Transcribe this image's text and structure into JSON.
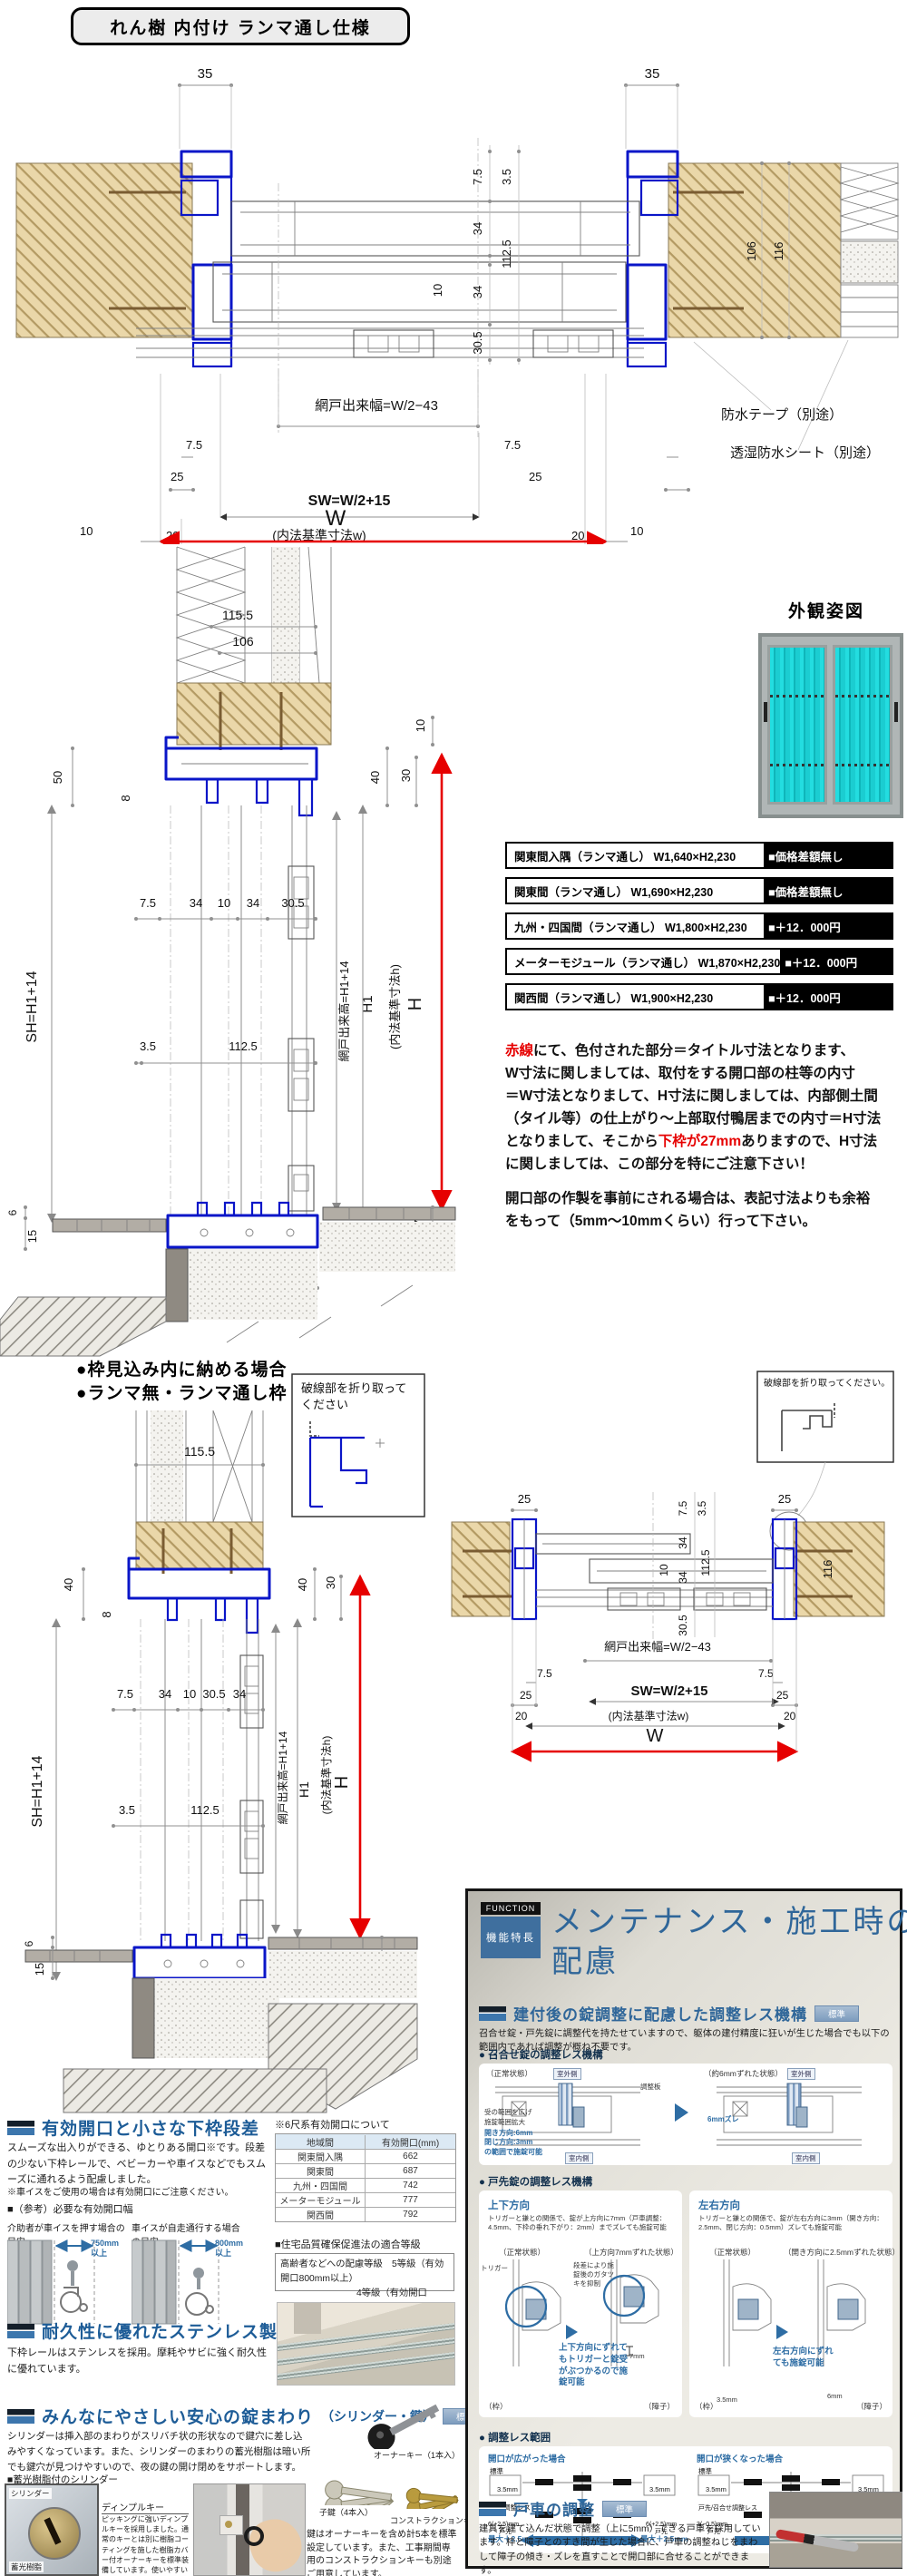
{
  "title": "れん樹 内付け ランマ通し仕様",
  "dims": {
    "n35": "35",
    "n75": "7.5",
    "n35s": "3.5",
    "n34": "34",
    "n10": "10",
    "n1125": "112.5",
    "n305": "30.5",
    "n25": "25",
    "n20": "20",
    "n106": "106",
    "n116": "116",
    "n1155": "115.5",
    "n50": "50",
    "n8": "8",
    "n40": "40",
    "n30": "30",
    "n6": "6",
    "n15": "15",
    "n112": "112",
    "n27": "27",
    "amido_w": "網戸出来幅=W/2−43",
    "sw": "SW=W/2+15",
    "naihou_w": "(内法基準寸法w)",
    "W": "W",
    "sh": "SH=H1+14",
    "amido_h": "網戸出来高=H1+14",
    "h1": "H1",
    "naihou_h": "(内法基準寸法h)",
    "H": "H"
  },
  "top": {
    "tape": "防水テープ（別途）",
    "sheet": "透湿防水シート（別途）"
  },
  "appearance": {
    "title": "外観姿図"
  },
  "price": {
    "rows": [
      {
        "label": "関東間入隅（ランマ通し） W1,640×H2,230",
        "price": "■価格差額無し"
      },
      {
        "label": "関東間（ランマ通し） W1,690×H2,230",
        "price": "■価格差額無し"
      },
      {
        "label": "九州・四国間（ランマ通し） W1,800×H2,230",
        "price": "■＋12．000円"
      },
      {
        "label": "メーターモジュール（ランマ通し） W1,870×H2,230",
        "price": "■＋12．000円"
      },
      {
        "label": "関西間（ランマ通し） W1,900×H2,230",
        "price": "■＋12．000円"
      }
    ]
  },
  "note": {
    "red1": "赤線",
    "t1": "にて、色付された部分＝タイトル寸法となります、",
    "t2": "W寸法に関しましては、取付をする開口部の柱等の内寸",
    "t3": "＝W寸法となりまして、H寸法に関しましては、内部側土間",
    "t4": "（タイル等）の仕上がり～上部取付鴨居までの内寸＝H寸法",
    "t5a": "となりまして、そこから",
    "red2": "下枠が27mm",
    "t5b": "ありますので、H寸法",
    "t6": "に関しましては、この部分を特にご注意下さい！",
    "t7": "開口部の作製を事前にされる場合は、表記寸法よりも余裕",
    "t8": "をもって（5mm～10mmくらい）行って下さい。"
  },
  "bl": {
    "b1": "●枠見込み内に納める場合",
    "b2": "●ランマ無・ランマ通し枠",
    "fold1a": "破線部を折り取って",
    "fold1b": "ください",
    "fold2": "破線部を折り取ってください。"
  },
  "feat": {
    "s1_title": "有効開口と小さな下枠段差",
    "s1_body": "スムーズな出入りができる、ゆとりある開口※です。段差の少ない下枠レールで、ベビーカーや車イスなどでもスムーズに通れるよう配慮しました。",
    "s1_note": "※車イスをご使用の場合は有効開口にご注意ください。",
    "s1_ref": "■（参考）必要な有効開口幅",
    "cap1": "介助者が車イスを押す場合の目安",
    "dim1a": "750mm",
    "dim1b": "以上",
    "cap2": "車イスが自走通行する場合の目安",
    "dim2a": "800mm",
    "dim2b": "以上",
    "tbl_title": "※6尺系有効開口について",
    "tbl_c1": "地域間",
    "tbl_c2": "有効開口(mm)",
    "tbl_rows": [
      [
        "関東間入隅",
        "662"
      ],
      [
        "関東間",
        "687"
      ],
      [
        "九州・四国間",
        "742"
      ],
      [
        "メーターモジュール",
        "777"
      ],
      [
        "関西間",
        "792"
      ]
    ],
    "grade_title": "■住宅品質確保促進法の適合等級",
    "grade1": "高齢者などへの配慮等級　5等級（有効開口800mm以上）",
    "grade2": "4等級（有効開口750mm以上）",
    "s2_title": "耐久性に優れたステンレス製下枠",
    "s2_body": "下枠レールはステンレスを採用。摩耗やサビに強く耐久性に優れています。",
    "s3_title": "みんなにやさしい安心の錠まわり",
    "s3_sub": "（シリンダー・鍵）",
    "std": "標準",
    "s3_body": "シリンダーは挿入部のまわりがスリバチ状の形状なので鍵穴に差し込みやすくなっています。また、シリンダーのまわりの蓄光樹脂は暗い所でも鍵穴が見つけやすいので、夜の鍵の開け閉めをサポートします。",
    "cyl_cap": "■蓄光樹脂付のシリンダー",
    "cyl1": "シリンダー",
    "cyl2": "蓄光樹脂",
    "dk_title": "ディンプルキー",
    "dk_body": "ピッキングに強いディンプルキーを採用しました。通常のキーとは別に樹脂コーティングを施した樹脂カバー付オーナーキーを標準装備しています。使いやすいリバーシブルキーです。",
    "key1": "オーナーキー（1本入）",
    "key2": "子鍵（4本入）",
    "key3": "コンストラクションキー",
    "keys_body": "鍵はオーナーキーを含め計5本を標準設定しています。また、工事期間専用のコンストラクションキーも別途ご用意しています。"
  },
  "fn": {
    "tag": "FUNCTION",
    "tag2": "機能特長",
    "title1": "メンテナンス・施工時の",
    "title2": "配慮",
    "h1": "建付後の錠調整に配慮した調整レス機構",
    "std": "標準",
    "h1_body": "召合せ錠・戸先錠に調整代を持たせていますので、躯体の建付精度に狂いが生じた場合でも以下の範囲内であれば調整が概ね不要です。",
    "b1": "● 召合せ錠の調整レス機構",
    "normal": "（正常状態）",
    "shift6": "（約6mmずれた状態）",
    "out": "室外側",
    "in": "室内側",
    "plate": "調整板",
    "note_a": "受の範囲を広げ",
    "note_b": "施錠範囲拡大",
    "dir1": "開き方向:6mm",
    "dir2": "閉じ方向:3mm",
    "dir3": "の範囲で施錠可能",
    "zure6": "6mmズレ",
    "b2": "● 戸先錠の調整レス機構",
    "ud_title": "上下方向",
    "ud_body": "トリガーと鎌との関係で、錠が上方向に7mm（戸車調整：4.5mm、下枠の垂れ下がり：2mm）までズレても施錠可能",
    "ud_shift": "（上方向7mmずれた状態）",
    "trigger": "トリガー",
    "ud_note": "段差により施錠後のガタツキを抑制",
    "ud_blue": "上下方向にずれてもトリガーと錠受がぶつかるので施錠可能",
    "frame": "（枠）",
    "shoji": "（障子）",
    "mm7": "7mm",
    "lr_title": "左右方向",
    "lr_body": "トリガーと鎌との関係で、錠が左右方向に3mm（開き方向：2.5mm、閉じ方向：0.5mm）ズレても施錠可能",
    "lr_shift": "（開き方向に2.5mmずれた状態）",
    "lr_blue": "左右方向にずれても施錠可能",
    "mm35": "3.5mm",
    "mm6": "6mm",
    "b3": "● 調整レス範囲",
    "wide": "開口が広がった場合",
    "narrow": "開口が狭くなった場合",
    "std2": "標準",
    "r35": "3.5mm",
    "tosaki_less": "戸先調整レス",
    "w625": "6(+2.5)mm",
    "tosaki": "戸先",
    "maxp": "最大＋2.5mm",
    "meet_less": "戸先/召合せ調整レス",
    "n305b": "3(−0.5)mm",
    "meet6": "6mm",
    "meet": "召合せ",
    "maxm": "最大−7mm",
    "h2": "戸車の調整",
    "h2_body": "建具を建て込んだ状態で調整（上に5mm）できる戸車を採用しています。枠と障子とのすき間が生じた場合に、戸車の調整ねじをまわして障子の傾き・ズレを直すことで開口部に合せることができます。"
  }
}
